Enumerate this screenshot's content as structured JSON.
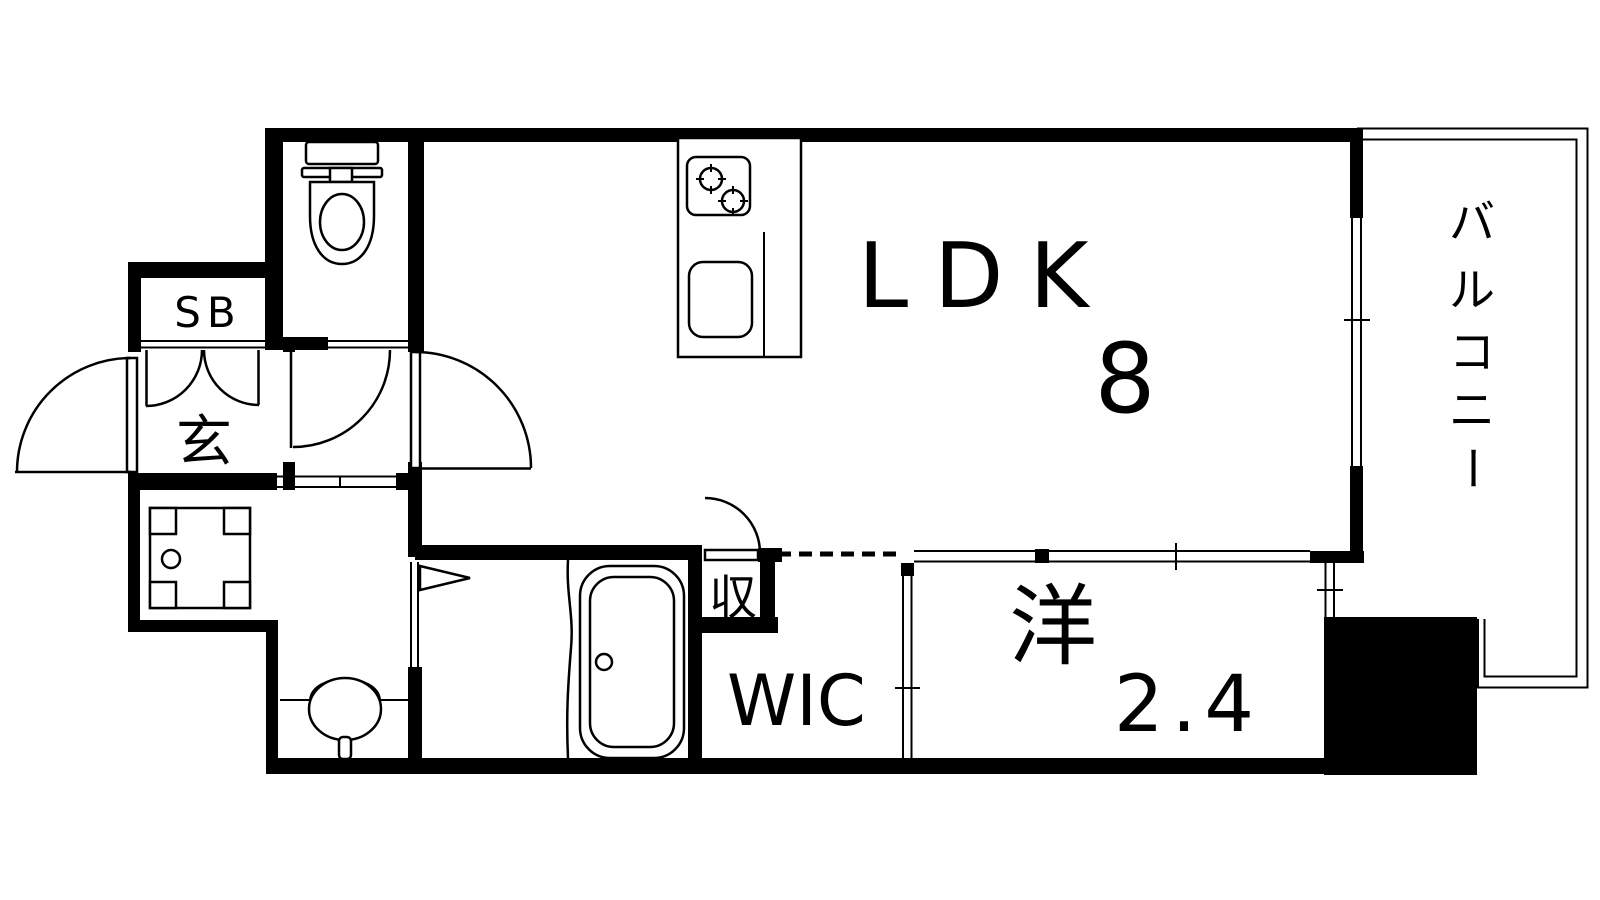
{
  "rooms": {
    "ldk": {
      "label": "LDK",
      "tatami": "8"
    },
    "western": {
      "label": "洋",
      "tatami": "2.4"
    },
    "balcony": {
      "label": "バルコニー",
      "chars": [
        "バ",
        "ル",
        "コ",
        "ニ",
        "ー"
      ]
    },
    "wic": {
      "label": "WIC"
    },
    "storage": {
      "label": "収"
    },
    "entrance": {
      "label": "玄"
    },
    "shoebox": {
      "label": "SB"
    }
  },
  "colors": {
    "line": "#000000",
    "background": "#ffffff"
  }
}
